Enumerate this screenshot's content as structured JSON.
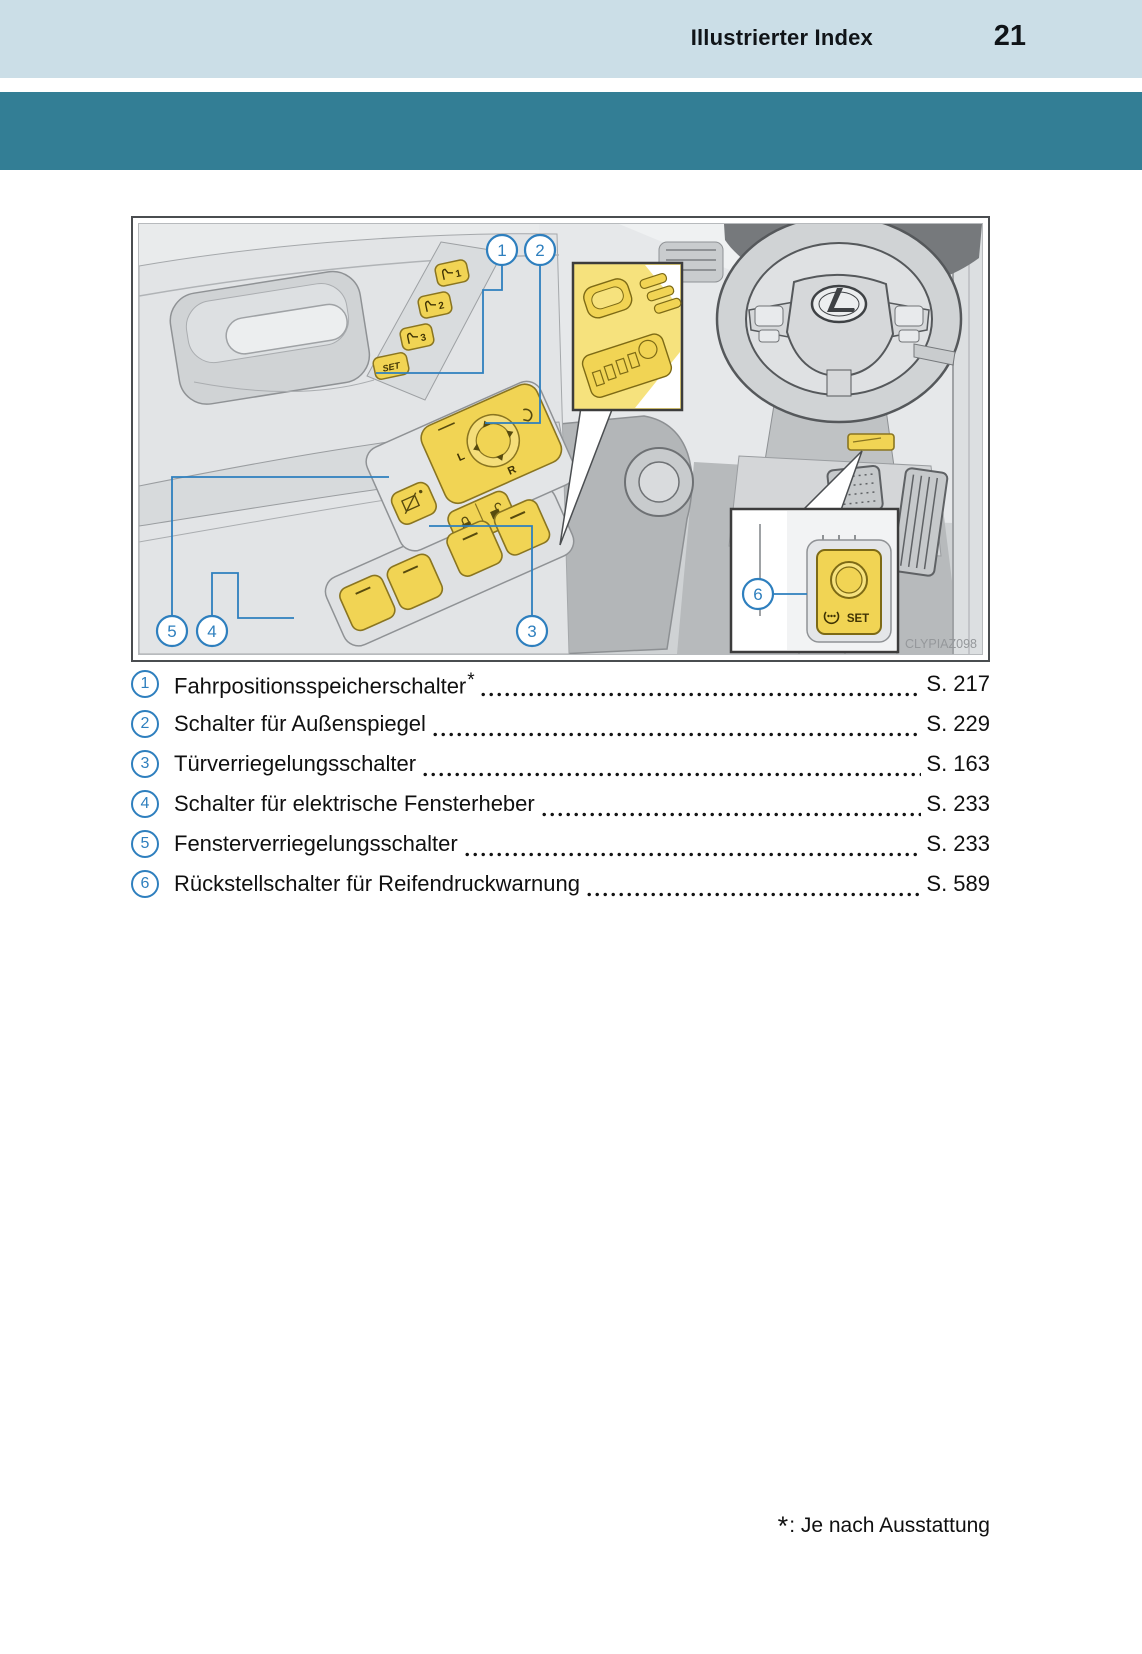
{
  "header": {
    "title": "Illustrierter Index",
    "page_number": "21"
  },
  "figure": {
    "watermark": "CLYPIAZ098",
    "callouts": [
      "1",
      "2",
      "3",
      "4",
      "5",
      "6"
    ],
    "memory_buttons": [
      "1",
      "2",
      "3"
    ],
    "memory_set_label": "SET",
    "mirror_left_label": "L",
    "mirror_right_label": "R",
    "tpms_set_label": "SET"
  },
  "index_list": {
    "items": [
      {
        "num": "1",
        "label": "Fahrpositionsspeicherschalter",
        "star": "*",
        "page": "S. 217"
      },
      {
        "num": "2",
        "label": "Schalter für Außenspiegel",
        "page": "S. 229"
      },
      {
        "num": "3",
        "label": "Türverriegelungsschalter",
        "page": "S. 163"
      },
      {
        "num": "4",
        "label": "Schalter für elektrische Fensterheber",
        "page": "S. 233"
      },
      {
        "num": "5",
        "label": "Fensterverriegelungsschalter",
        "page": "S. 233"
      },
      {
        "num": "6",
        "label": "Rückstellschalter für Reifendruckwarnung",
        "page": "S. 589"
      }
    ]
  },
  "footnote": {
    "symbol": "*",
    "text": ": Je nach Ausstattung"
  },
  "colors": {
    "header_band": "#cbdee7",
    "teal_band": "#337e95",
    "callout_blue": "#2e7fbe",
    "highlight_yellow": "#f1d454",
    "canvas_gray": "#e9ebec"
  }
}
